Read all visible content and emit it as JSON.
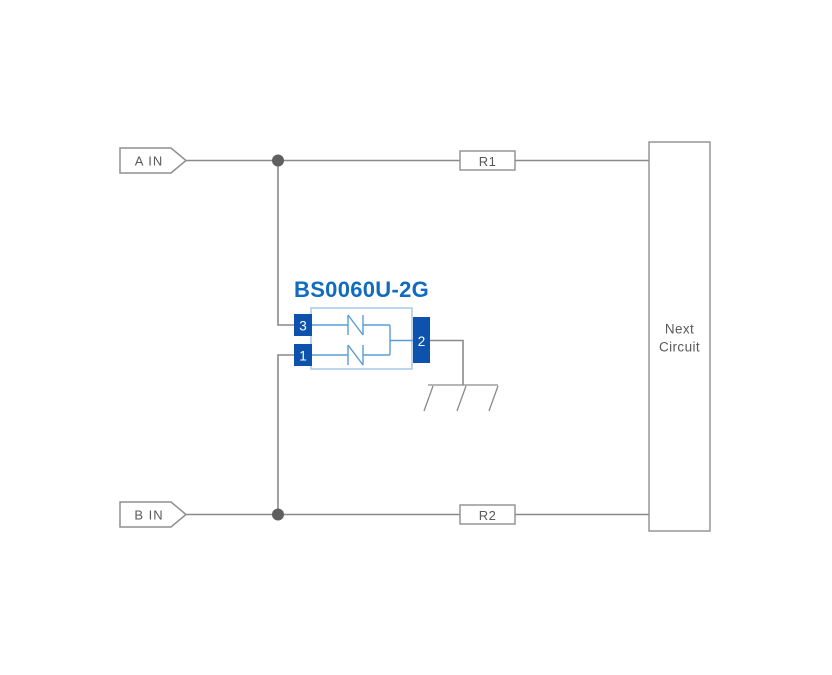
{
  "diagram": {
    "inputs": {
      "a": "A IN",
      "b": "B IN"
    },
    "resistors": {
      "r1": "R1",
      "r2": "R2"
    },
    "next_circuit": {
      "line1": "Next",
      "line2": "Circuit"
    },
    "component": {
      "label": "BS0060U-2G",
      "pins": {
        "pin3": "3",
        "pin1": "1",
        "pin2": "2"
      }
    },
    "colors": {
      "background": "#ffffff",
      "wire_gray": "#8a8a8a",
      "box_stroke_gray": "#8f8f8f",
      "text_gray": "#595959",
      "junction_dot": "#5f5f5f",
      "component_label_blue": "#0f6cbe",
      "pin_fill_blue": "#0d53ae",
      "component_body_outline": "#a9c7e8",
      "internal_wire_blue": "#5b9bd5"
    }
  }
}
